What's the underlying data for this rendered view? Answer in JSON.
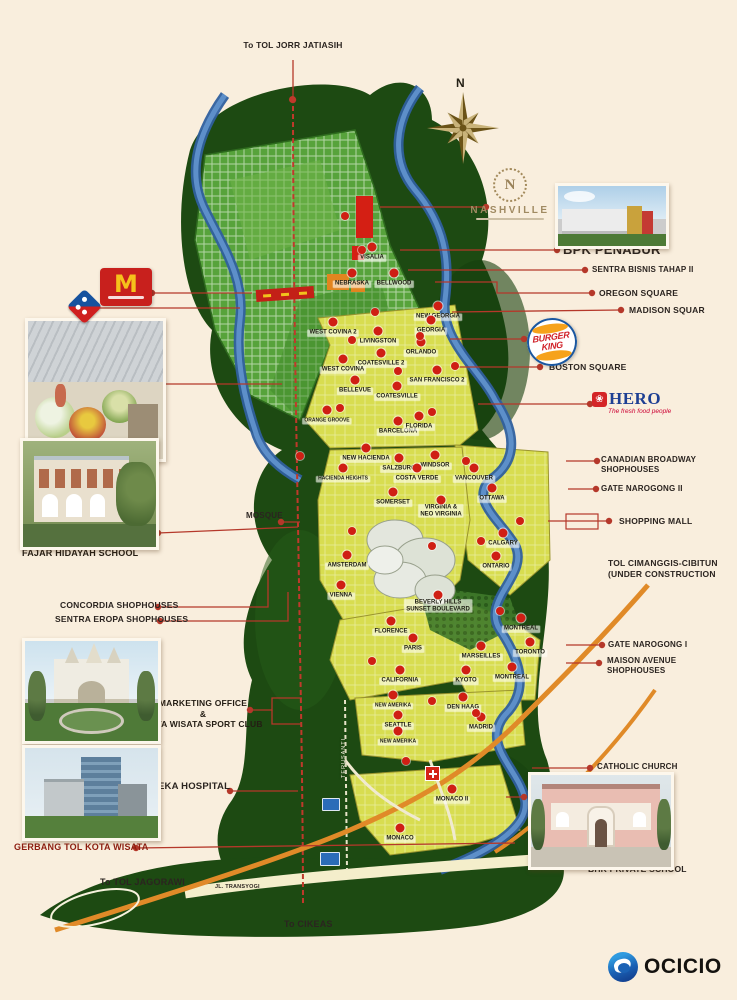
{
  "canvas": {
    "bg": "#f9eedd",
    "accent_line": "#b5382a",
    "dark_red": "#8e1d10"
  },
  "header": {
    "top_road": "To TOL JORR JATIASIH",
    "compass_n": "N"
  },
  "branding": {
    "ocicio": "OCICIO"
  },
  "logos": {
    "nashville": {
      "initial": "N",
      "name": "NASHVILLE"
    },
    "mcdonalds": {
      "arch": "M"
    },
    "burger_king": {
      "line1": "BURGER",
      "line2": "KING"
    },
    "hero": {
      "icon": "❀",
      "name": "HERO",
      "tagline": "The fresh food people"
    }
  },
  "callouts": [
    {
      "id": "top-jorr",
      "lines": [
        "To TOL JORR JATIASIH"
      ],
      "x": 293,
      "y": 40,
      "size": 8.5,
      "center": true
    },
    {
      "id": "bpk-penabur",
      "lines": [
        "BPK PENABUR"
      ],
      "x": 563,
      "y": 242,
      "size": 13
    },
    {
      "id": "sentra-bisnis",
      "lines": [
        "SENTRA BISNIS TAHAP II"
      ],
      "x": 592,
      "y": 265,
      "size": 8
    },
    {
      "id": "oregon-square",
      "lines": [
        "OREGON SQUARE"
      ],
      "x": 599,
      "y": 288,
      "size": 8.5
    },
    {
      "id": "madison-squar",
      "lines": [
        "MADISON SQUAR"
      ],
      "x": 629,
      "y": 305,
      "size": 8.5
    },
    {
      "id": "boston-square",
      "lines": [
        "BOSTON SQUARE"
      ],
      "x": 549,
      "y": 362,
      "size": 8.5
    },
    {
      "id": "canadian-broadway",
      "lines": [
        "CANADIAN BROADWAY",
        "SHOPHOUSES"
      ],
      "x": 601,
      "y": 455,
      "size": 8
    },
    {
      "id": "gate-narogong-2",
      "lines": [
        "GATE NAROGONG II"
      ],
      "x": 601,
      "y": 484,
      "size": 8
    },
    {
      "id": "shopping-mall",
      "lines": [
        "SHOPPING MALL"
      ],
      "x": 619,
      "y": 516,
      "size": 8.5
    },
    {
      "id": "tol-cimanggis",
      "lines": [
        "TOL CIMANGGIS-CIBITUN",
        "(UNDER CONSTRUCTION"
      ],
      "x": 608,
      "y": 558,
      "size": 8.5
    },
    {
      "id": "gate-narogong-1",
      "lines": [
        "GATE NAROGONG I"
      ],
      "x": 608,
      "y": 640,
      "size": 8
    },
    {
      "id": "maison-avenue",
      "lines": [
        "MAISON AVENUE",
        "SHOPHOUSES"
      ],
      "x": 607,
      "y": 656,
      "size": 8
    },
    {
      "id": "catholic-church",
      "lines": [
        "CATHOLIC CHURCH"
      ],
      "x": 597,
      "y": 762,
      "size": 8
    },
    {
      "id": "bhk-caption",
      "lines": [
        "BHK PRIVATE SCHOOL"
      ],
      "x": 588,
      "y": 864,
      "size": 8.5
    },
    {
      "id": "fresh-caption",
      "lines": [
        "FRESH MARKET"
      ],
      "x": 30,
      "y": 461,
      "size": 9,
      "caption": true
    },
    {
      "id": "fajar-caption",
      "lines": [
        "FAJAR HIDAYAH SCHOOL"
      ],
      "x": 22,
      "y": 548,
      "size": 9,
      "caption": true
    },
    {
      "id": "mosque",
      "lines": [
        "MOSQUE"
      ],
      "x": 246,
      "y": 511,
      "size": 8
    },
    {
      "id": "concordia",
      "lines": [
        "CONCORDIA SHOPHOUSES"
      ],
      "x": 60,
      "y": 600,
      "size": 8.5,
      "bold": true
    },
    {
      "id": "sentra-eropa",
      "lines": [
        "SENTRA EROPA SHOPHOUSES"
      ],
      "x": 55,
      "y": 614,
      "size": 8.5
    },
    {
      "id": "marketing-office",
      "lines": [
        "MARKETING OFFICE",
        "&",
        "KOTA WISATA SPORT CLUB"
      ],
      "x": 203,
      "y": 698,
      "size": 8.5,
      "center": true,
      "caption": true
    },
    {
      "id": "eka-hospital",
      "lines": [
        "EKA HOSPITAL"
      ],
      "x": 158,
      "y": 781,
      "size": 9.5,
      "bold": true
    },
    {
      "id": "gerbang-tol",
      "lines": [
        "GERBANG TOL KOTA WISATA"
      ],
      "x": 14,
      "y": 842,
      "size": 9,
      "bold": true,
      "color": "#8e1d10"
    },
    {
      "id": "to-jagorawi",
      "lines": [
        "To TOL JAGORAWI"
      ],
      "x": 100,
      "y": 877,
      "size": 9,
      "bold": true
    },
    {
      "id": "jl-transyogi",
      "lines": [
        "JL. TRANSYOGI"
      ],
      "x": 215,
      "y": 884,
      "size": 5.5
    },
    {
      "id": "to-cikeas",
      "lines": [
        "To CIKEAS"
      ],
      "x": 284,
      "y": 919,
      "size": 9,
      "bold": true
    }
  ],
  "map": {
    "regions": [
      {
        "n": "VISALIA",
        "x": 372,
        "y": 258
      },
      {
        "n": "NEBRASKA",
        "x": 352,
        "y": 284
      },
      {
        "n": "BELLWOOD",
        "x": 394,
        "y": 284
      },
      {
        "n": "NEW GEORGIA",
        "x": 438,
        "y": 317
      },
      {
        "n": "WEST COVINA 2",
        "x": 333,
        "y": 333
      },
      {
        "n": "GEORGIA",
        "x": 431,
        "y": 331
      },
      {
        "n": "LIVINGSTON",
        "x": 378,
        "y": 342
      },
      {
        "n": "ORLANDO",
        "x": 421,
        "y": 353
      },
      {
        "n": "COATESVILLE 2",
        "x": 381,
        "y": 364
      },
      {
        "n": "WEST COVINA",
        "x": 343,
        "y": 370
      },
      {
        "n": "SAN FRANCISCO 2",
        "x": 437,
        "y": 381
      },
      {
        "n": "BELLEVUE",
        "x": 355,
        "y": 391
      },
      {
        "n": "COATESVILLE",
        "x": 397,
        "y": 397
      },
      {
        "n": "ORANGE GROOVE",
        "x": 327,
        "y": 421,
        "sm": true
      },
      {
        "n": "BARCELONA",
        "x": 398,
        "y": 432
      },
      {
        "n": "FLORIDA",
        "x": 419,
        "y": 427
      },
      {
        "n": "NEW HACIENDA",
        "x": 366,
        "y": 459
      },
      {
        "n": "SALZBURG",
        "x": 399,
        "y": 469
      },
      {
        "n": "WINDSOR",
        "x": 435,
        "y": 466
      },
      {
        "n": "HACIENDA HEIGHTS",
        "x": 343,
        "y": 479,
        "sm": true
      },
      {
        "n": "COSTA VERDE",
        "x": 417,
        "y": 479
      },
      {
        "n": "VANCOUVER",
        "x": 474,
        "y": 479
      },
      {
        "n": "SOMERSET",
        "x": 393,
        "y": 503
      },
      {
        "n": "OTTAWA",
        "x": 492,
        "y": 499
      },
      {
        "n": "VIRGINIA &\nNEO VIRGINIA",
        "x": 441,
        "y": 511
      },
      {
        "n": "CALGARY",
        "x": 503,
        "y": 544
      },
      {
        "n": "AMSTERDAM",
        "x": 347,
        "y": 566
      },
      {
        "n": "ONTARIO",
        "x": 496,
        "y": 567
      },
      {
        "n": "VIENNA",
        "x": 341,
        "y": 596
      },
      {
        "n": "BEVERLY HILLS\nSUNSET BOULEVARD",
        "x": 438,
        "y": 606
      },
      {
        "n": "FLORENCE",
        "x": 391,
        "y": 632
      },
      {
        "n": "MONTREAL",
        "x": 521,
        "y": 629
      },
      {
        "n": "PARIS",
        "x": 413,
        "y": 649
      },
      {
        "n": "TORONTO",
        "x": 530,
        "y": 653
      },
      {
        "n": "MARSEILLES",
        "x": 481,
        "y": 657
      },
      {
        "n": "MONTREAL",
        "x": 512,
        "y": 678
      },
      {
        "n": "CALIFORNIA",
        "x": 400,
        "y": 681
      },
      {
        "n": "KYOTO",
        "x": 466,
        "y": 681
      },
      {
        "n": "NEW AMERIKA",
        "x": 393,
        "y": 706,
        "sm": true
      },
      {
        "n": "DEN HAAG",
        "x": 463,
        "y": 708
      },
      {
        "n": "SEATTLE",
        "x": 398,
        "y": 726
      },
      {
        "n": "MADRID",
        "x": 481,
        "y": 728
      },
      {
        "n": "NEW AMERIKA",
        "x": 398,
        "y": 742,
        "sm": true
      },
      {
        "n": "MONACO II",
        "x": 452,
        "y": 800
      },
      {
        "n": "MONACO",
        "x": 400,
        "y": 839
      }
    ],
    "road_labels": {
      "terusan": "TERUSANTI"
    },
    "extra_badges": [
      [
        345,
        216
      ],
      [
        362,
        250
      ],
      [
        375,
        312
      ],
      [
        352,
        340
      ],
      [
        420,
        336
      ],
      [
        398,
        371
      ],
      [
        455,
        366
      ],
      [
        340,
        408
      ],
      [
        432,
        412
      ],
      [
        300,
        456
      ],
      [
        466,
        461
      ],
      [
        520,
        521
      ],
      [
        481,
        541
      ],
      [
        352,
        531
      ],
      [
        432,
        546
      ],
      [
        500,
        611
      ],
      [
        372,
        661
      ],
      [
        432,
        701
      ],
      [
        476,
        713
      ],
      [
        406,
        761
      ]
    ]
  },
  "leaders": [
    {
      "d": [
        [
          293,
          100
        ],
        [
          293,
          60
        ]
      ]
    },
    {
      "d": [
        [
          152,
          293
        ],
        [
          252,
          293
        ]
      ]
    },
    {
      "d": [
        [
          90,
          308
        ],
        [
          240,
          308
        ]
      ]
    },
    {
      "d": [
        [
          160,
          384
        ],
        [
          282,
          384
        ]
      ]
    },
    {
      "d": [
        [
          158,
          533
        ],
        [
          298,
          527
        ]
      ]
    },
    {
      "d": [
        [
          281,
          522
        ],
        [
          300,
          522
        ]
      ]
    },
    {
      "d": [
        [
          158,
          607
        ],
        [
          268,
          607
        ],
        [
          268,
          570
        ]
      ]
    },
    {
      "d": [
        [
          160,
          621
        ],
        [
          288,
          621
        ],
        [
          288,
          592
        ]
      ]
    },
    {
      "d": [
        [
          250,
          710
        ],
        [
          272,
          710
        ],
        [
          272,
          698
        ],
        [
          302,
          698
        ]
      ]
    },
    {
      "d": [
        [
          272,
          710
        ],
        [
          272,
          724
        ],
        [
          302,
          724
        ]
      ],
      "nodot": true
    },
    {
      "d": [
        [
          230,
          791
        ],
        [
          298,
          791
        ]
      ]
    },
    {
      "d": [
        [
          136,
          848
        ],
        [
          515,
          843
        ]
      ]
    },
    {
      "d": [
        [
          486,
          207
        ],
        [
          380,
          207
        ]
      ]
    },
    {
      "d": [
        [
          557,
          250
        ],
        [
          400,
          250
        ]
      ]
    },
    {
      "d": [
        [
          585,
          270
        ],
        [
          408,
          270
        ]
      ]
    },
    {
      "d": [
        [
          592,
          293
        ],
        [
          497,
          293
        ],
        [
          497,
          282
        ],
        [
          435,
          282
        ]
      ]
    },
    {
      "d": [
        [
          621,
          310
        ],
        [
          452,
          312
        ]
      ]
    },
    {
      "d": [
        [
          524,
          339
        ],
        [
          450,
          339
        ]
      ]
    },
    {
      "d": [
        [
          540,
          367
        ],
        [
          455,
          367
        ]
      ]
    },
    {
      "d": [
        [
          590,
          404
        ],
        [
          478,
          404
        ]
      ]
    },
    {
      "d": [
        [
          597,
          461
        ],
        [
          566,
          461
        ]
      ]
    },
    {
      "d": [
        [
          596,
          489
        ],
        [
          568,
          489
        ]
      ]
    },
    {
      "d": [
        [
          609,
          521
        ],
        [
          548,
          521
        ]
      ]
    },
    {
      "d": [
        [
          602,
          645
        ],
        [
          566,
          645
        ]
      ]
    },
    {
      "d": [
        [
          599,
          663
        ],
        [
          566,
          663
        ]
      ]
    },
    {
      "d": [
        [
          590,
          768
        ],
        [
          532,
          768
        ]
      ]
    },
    {
      "d": [
        [
          524,
          797
        ],
        [
          506,
          797
        ]
      ]
    }
  ],
  "leader_rects": [
    [
      566,
      514,
      32,
      15
    ]
  ]
}
